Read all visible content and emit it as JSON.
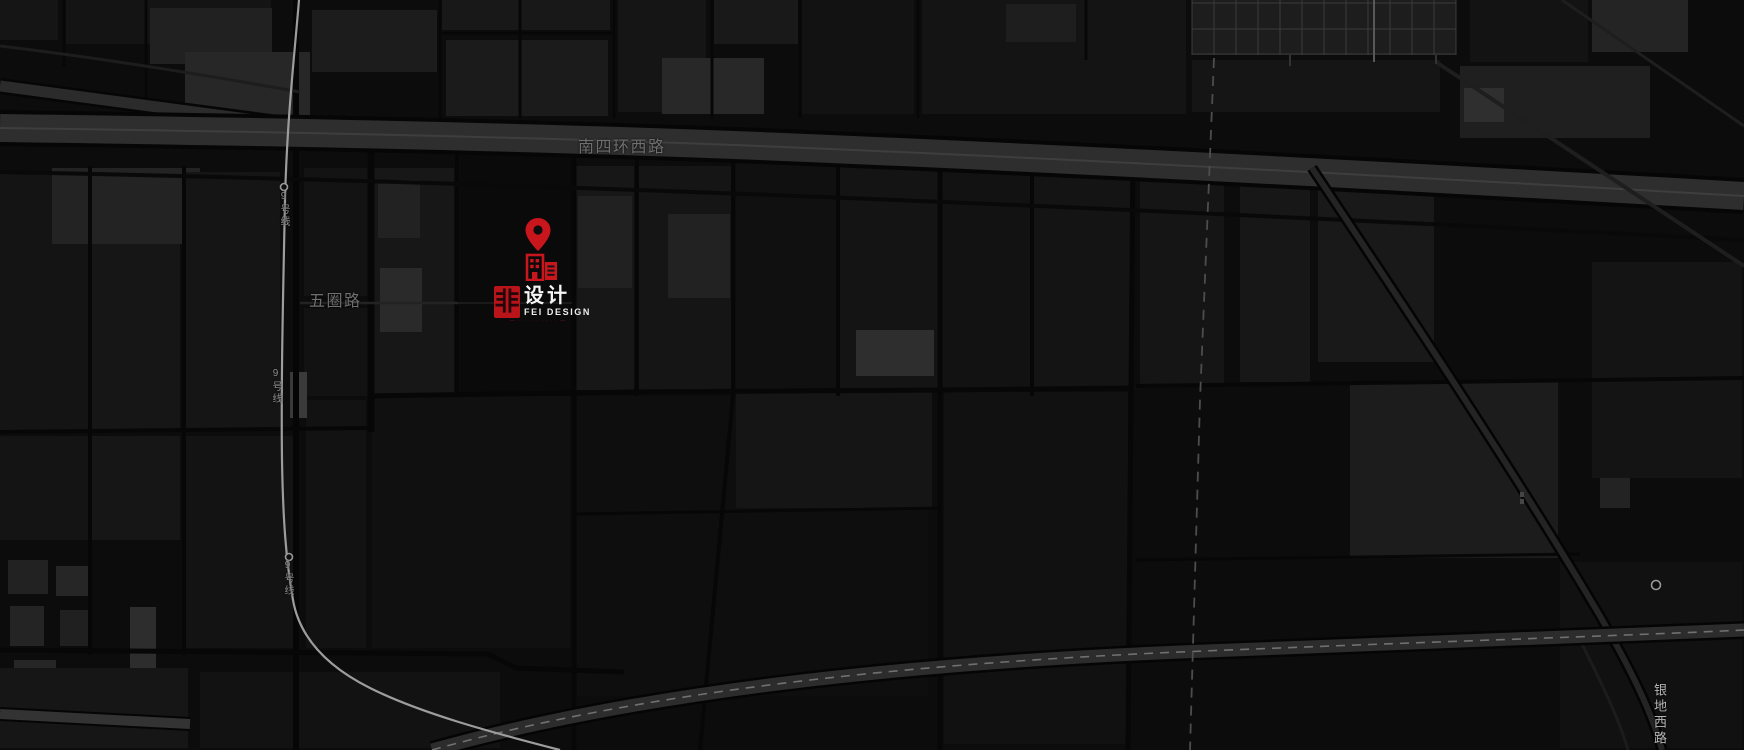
{
  "map": {
    "labels": {
      "main_road": "南四环西路",
      "wuquan_road": "五圈路",
      "metro_line_9": "9号线",
      "yindi_west_road": "银地西路"
    },
    "marker": {
      "type": "location-pin-with-building",
      "color": "#c9161d"
    },
    "logo": {
      "seal_char": "非",
      "name_zh": "设计",
      "name_en": "FEI DESIGN",
      "tagline": "— · · · · · · · · · —"
    },
    "colors": {
      "background": "#0c0c0c",
      "block_gray": "#181818",
      "road_gray": "#2e2e2e",
      "metro_line_gray": "#9d9d9d",
      "label_gray": "#6f6f6f",
      "accent_red": "#c9161d"
    }
  }
}
